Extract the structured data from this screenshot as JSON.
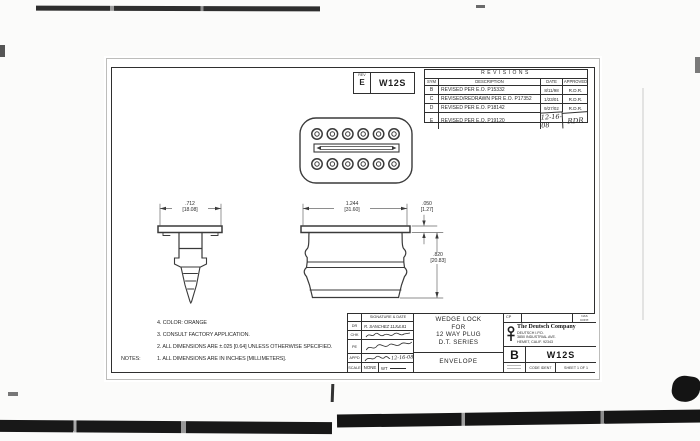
{
  "ink": "#2b2b2b",
  "paper": "#ffffff",
  "rev_box": {
    "rev_label": "REV",
    "rev": "E",
    "number": "W12S"
  },
  "revisions": {
    "title": "REVISIONS",
    "headers": [
      "SYM",
      "DESCRIPTION",
      "DATE",
      "APPROVED"
    ],
    "rows": [
      {
        "sym": "B",
        "description": "REVISED PER E.O. P15332",
        "date": "8/11/98",
        "approved": "R.D.R."
      },
      {
        "sym": "C",
        "description": "REVISED/REDRAWN PER E.O. P17352",
        "date": "1/23/01",
        "approved": "R.D.R."
      },
      {
        "sym": "D",
        "description": "REVISED PER E.O. P18142",
        "date": "9/27/02",
        "approved": "R.D.R."
      },
      {
        "sym": "E",
        "description": "REVISED PER E.O. P19120",
        "date": "12-16-08",
        "approved": "RDR"
      }
    ]
  },
  "dimensions": {
    "flange_width": {
      "in": ".712",
      "mm": "[18.08]"
    },
    "body_width": {
      "in": "1.244",
      "mm": "[31.60]"
    },
    "flange_thickness": {
      "in": ".050",
      "mm": "[1.27]"
    },
    "body_height": {
      "in": ".820",
      "mm": "[20.83]"
    }
  },
  "notes": {
    "prefix": "NOTES:",
    "items": [
      "1. ALL DIMENSIONS ARE IN INCHES [MILLIMETERS].",
      "2. ALL DIMENSIONS ARE ±.025 [0.64] UNLESS OTHERWISE SPECIFIED.",
      "3. CONSULT FACTORY APPLICATION.",
      "4. COLOR: ORANGE"
    ]
  },
  "title_block": {
    "signature_header": "SIGNATURE & DATE",
    "sig_rows": [
      {
        "label": "DR",
        "value": "R. SANCHEZ 11JUL81"
      },
      {
        "label": "CHK",
        "value": ""
      },
      {
        "label": "PE",
        "value": ""
      },
      {
        "label": "APPD",
        "value": "12-16-08"
      }
    ],
    "scale_label": "SCALE",
    "scale_value": "NONE",
    "wt_label": "WT",
    "title_lines": [
      "WEDGE LOCK",
      "FOR",
      "12 WAY PLUG",
      "D.T. SERIES"
    ],
    "subtitle": "ENVELOPE",
    "cp_label": "CP",
    "contract_line1": "NAS",
    "contract_line2": "CONT.",
    "company": {
      "name": "The Deutsch Company",
      "lines": [
        "DEUTSCH I.P.D.",
        "3850 INDUSTRIAL AVE.",
        "HEMET, CALIF. 92343"
      ]
    },
    "size": "B",
    "drawing_number": "W12S",
    "code_ident_label": "CODE IDENT",
    "sheet_label": "SHEET 1 OF 1"
  }
}
